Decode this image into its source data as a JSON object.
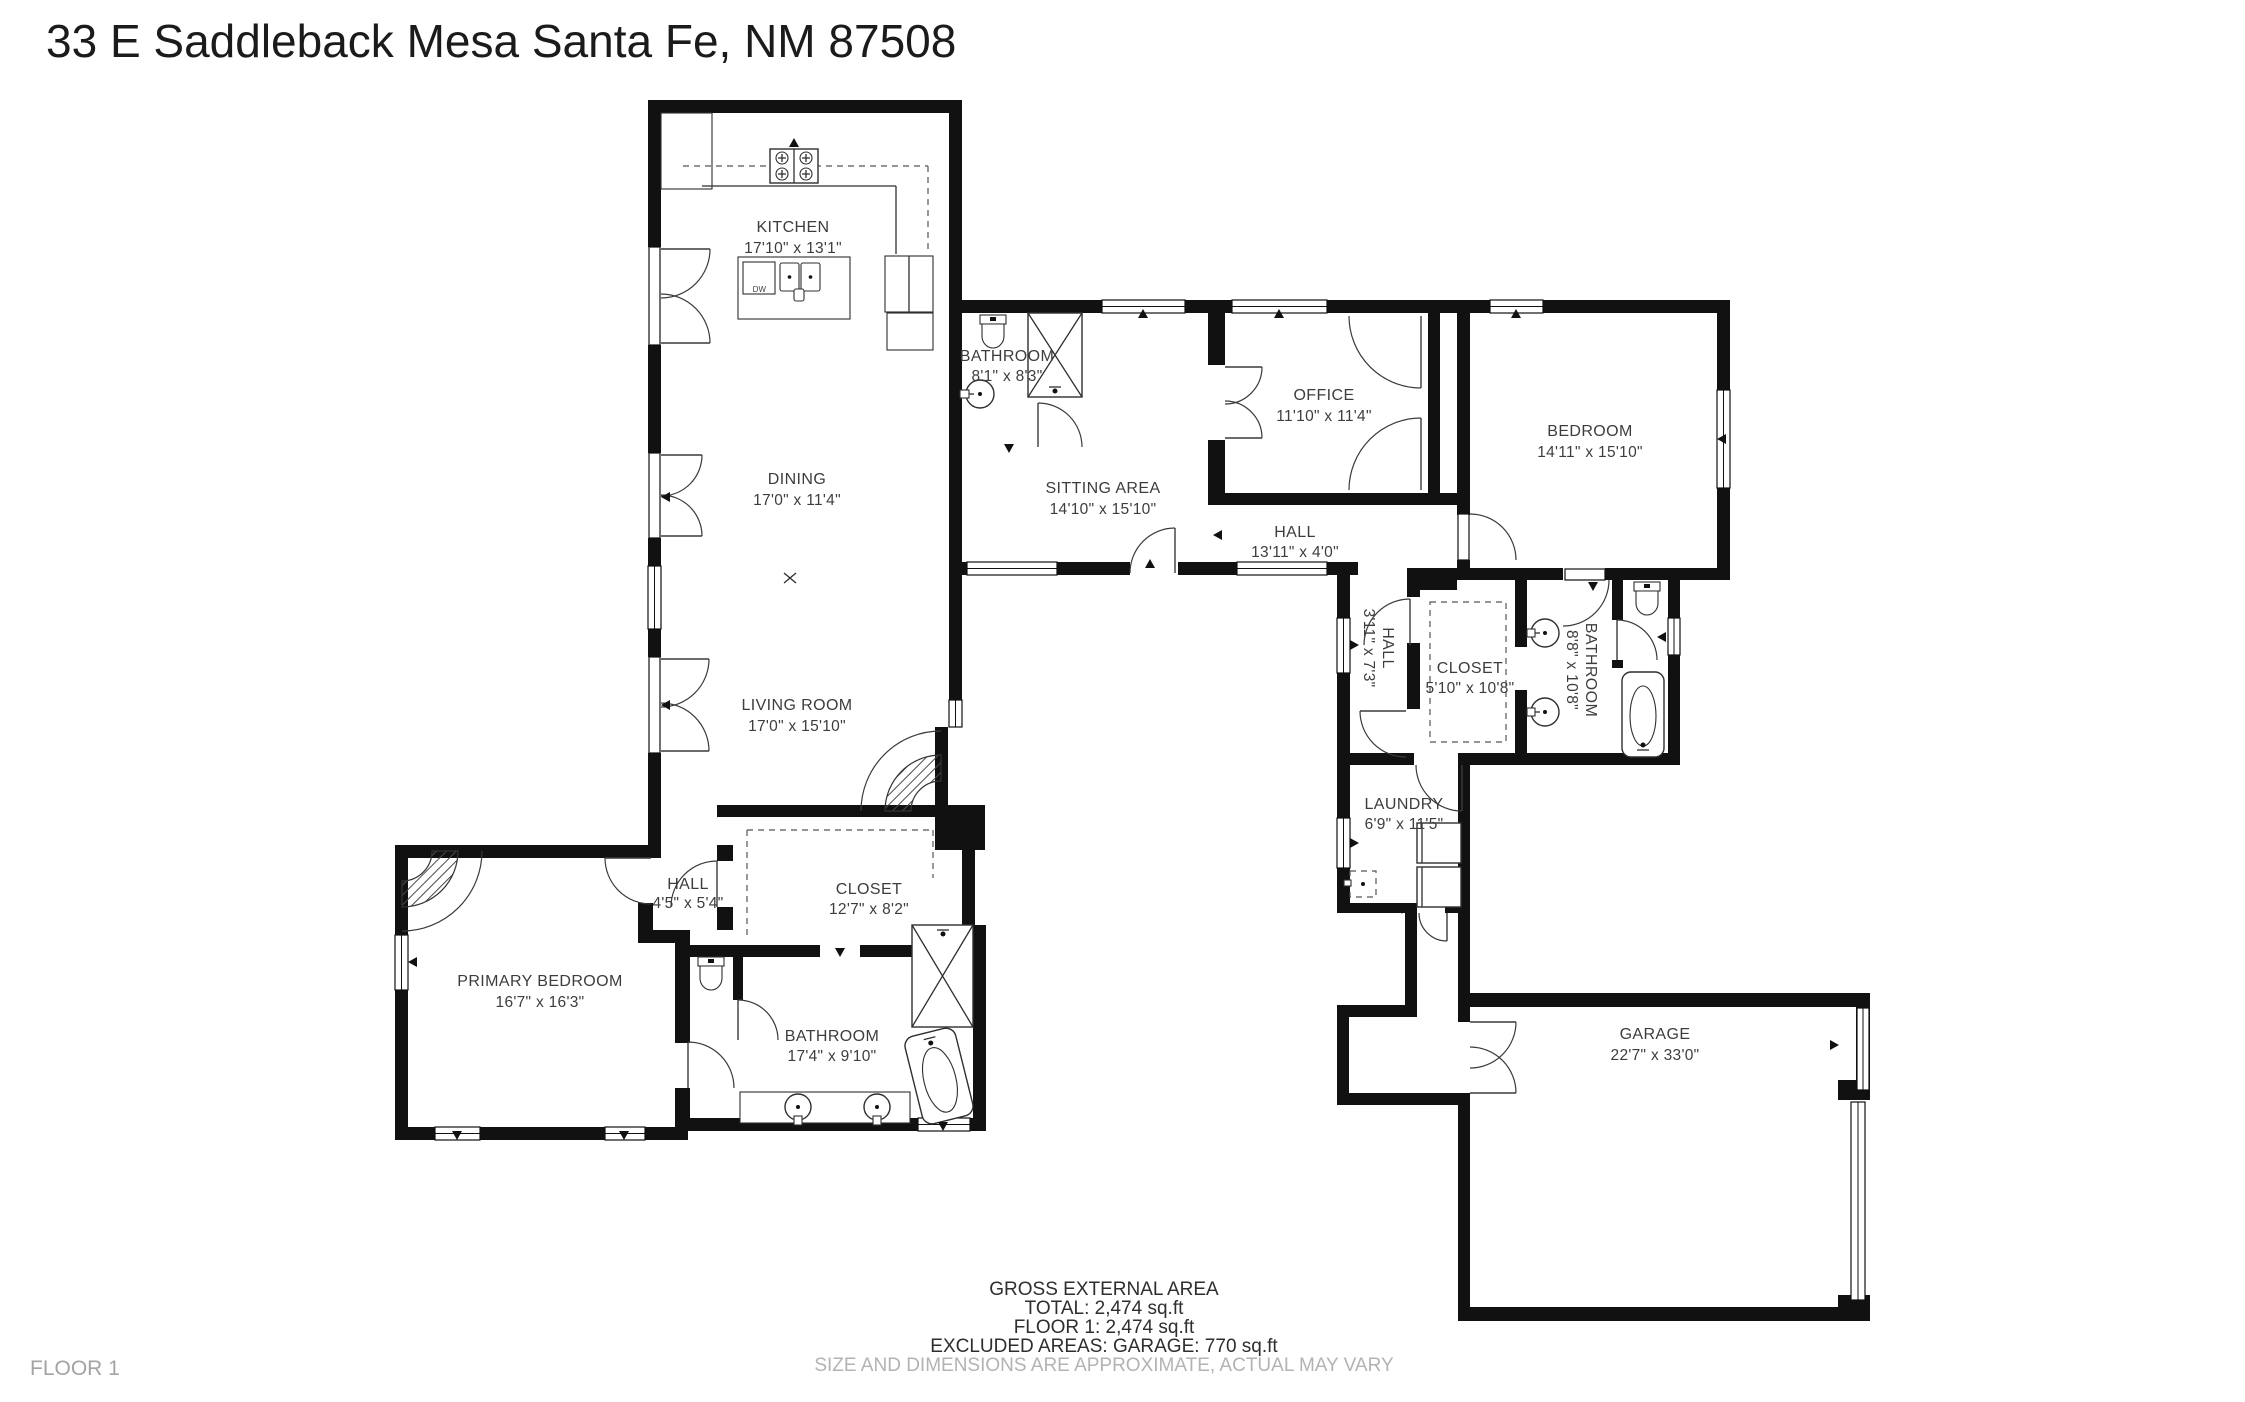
{
  "title": "33 E Saddleback Mesa Santa Fe, NM 87508",
  "floor_label": "FLOOR 1",
  "footer": {
    "area_heading": "GROSS EXTERNAL AREA",
    "total": "TOTAL: 2,474 sq.ft",
    "floor1": "FLOOR 1: 2,474 sq.ft",
    "excluded": "EXCLUDED AREAS: GARAGE: 770 sq.ft",
    "disclaimer": "SIZE AND DIMENSIONS ARE APPROXIMATE, ACTUAL MAY VARY"
  },
  "appliances": {
    "dishwasher": "DW"
  },
  "colors": {
    "wall": "#111111",
    "label": "#3d3d3d",
    "muted": "#b3b3b3"
  },
  "rooms": {
    "kitchen": {
      "name": "KITCHEN",
      "dims": "17'10\" x 13'1\""
    },
    "dining": {
      "name": "DINING",
      "dims": "17'0\" x 11'4\""
    },
    "living_room": {
      "name": "LIVING ROOM",
      "dims": "17'0\" x 15'10\""
    },
    "bathroom_guest": {
      "name": "BATHROOM",
      "dims": "8'1\" x 8'3\""
    },
    "sitting_area": {
      "name": "SITTING AREA",
      "dims": "14'10\" x 15'10\""
    },
    "office": {
      "name": "OFFICE",
      "dims": "11'10\" x 11'4\""
    },
    "bedroom": {
      "name": "BEDROOM",
      "dims": "14'11\" x 15'10\""
    },
    "hall_main": {
      "name": "HALL",
      "dims": "13'11\" x 4'0\""
    },
    "hall_vertical": {
      "name": "HALL",
      "dims": "3'11\" x 7'3\""
    },
    "closet_right": {
      "name": "CLOSET",
      "dims": "5'10\" x 10'8\""
    },
    "bathroom_right": {
      "name": "BATHROOM",
      "dims": "8'8\" x 10'8\""
    },
    "laundry": {
      "name": "LAUNDRY",
      "dims": "6'9\" x 11'5\""
    },
    "garage": {
      "name": "GARAGE",
      "dims": "22'7\" x 33'0\""
    },
    "primary_bedroom": {
      "name": "PRIMARY BEDROOM",
      "dims": "16'7\" x 16'3\""
    },
    "hall_small": {
      "name": "HALL",
      "dims": "4'5\" x 5'4\""
    },
    "closet_primary": {
      "name": "CLOSET",
      "dims": "12'7\" x 8'2\""
    },
    "bathroom_primary": {
      "name": "BATHROOM",
      "dims": "17'4\" x 9'10\""
    }
  }
}
